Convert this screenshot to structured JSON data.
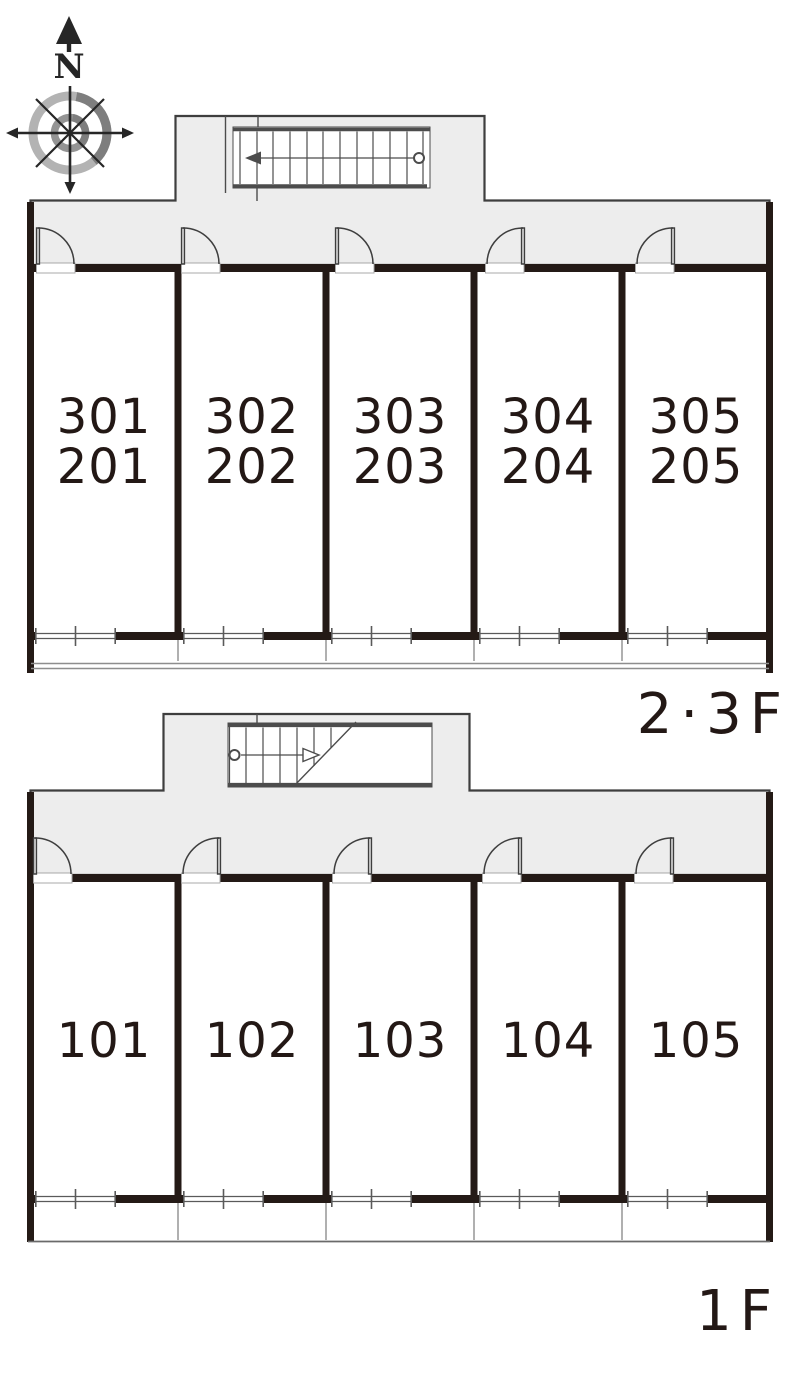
{
  "compass": {
    "north_label": "N"
  },
  "floors": [
    {
      "id": "2-3F",
      "floor_label": "2·3F",
      "rooms": [
        {
          "line1": "301",
          "line2": "201"
        },
        {
          "line1": "302",
          "line2": "202"
        },
        {
          "line1": "303",
          "line2": "203"
        },
        {
          "line1": "304",
          "line2": "204"
        },
        {
          "line1": "305",
          "line2": "205"
        }
      ]
    },
    {
      "id": "1F",
      "floor_label": "1F",
      "rooms": [
        {
          "line1": "101"
        },
        {
          "line1": "102"
        },
        {
          "line1": "103"
        },
        {
          "line1": "104"
        },
        {
          "line1": "105"
        }
      ]
    }
  ],
  "colors": {
    "wall": "#241a16",
    "corridor": "#ededed",
    "outline": "#3e3e3e",
    "door": "#3e3e3e",
    "stair": "#4c4c4c",
    "window": "#5a5a5a",
    "balcony": "#8e8e8e",
    "text": "#231815",
    "compass-ink": "#262626",
    "compass-light": "#b3b3b3",
    "compass-mid": "#949494",
    "compass-dark": "#7e7e7e"
  }
}
